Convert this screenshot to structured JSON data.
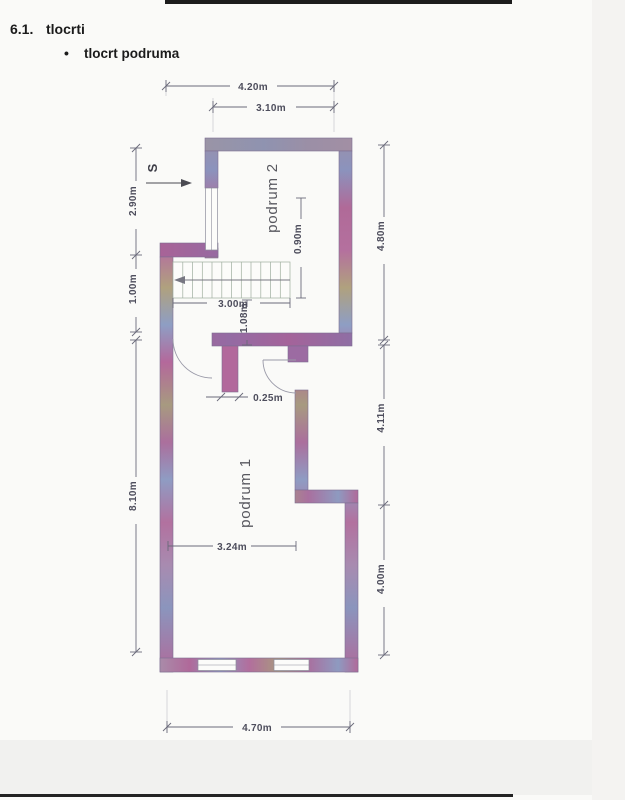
{
  "header": {
    "section_number": "6.1.",
    "section_title": "tlocrti",
    "bullet": "•",
    "bullet_item": "tlocrt podruma"
  },
  "plan": {
    "rooms": {
      "room2": "podrum 2",
      "room1": "podrum 1"
    },
    "north_marker": "S",
    "dims": {
      "top_outer": "4.20m",
      "top_inner": "3.10m",
      "left_upper": "2.90m",
      "left_mid": "1.00m",
      "left_lower": "8.10m",
      "right_upper": "4.80m",
      "right_mid": "4.11m",
      "right_lower": "4.00m",
      "bottom": "4.70m",
      "stairs_width": "3.00m",
      "stairs_depth": "0.90m",
      "opening": "1.08m",
      "partition": "0.25m",
      "room1_width": "3.24m"
    },
    "colors": {
      "wall_pink": "#b06a98",
      "wall_blue": "#8b93bd",
      "wall_tan": "#b0a17e",
      "wall_gray": "#9a94a6",
      "dim_line": "#6a6a7a"
    }
  }
}
